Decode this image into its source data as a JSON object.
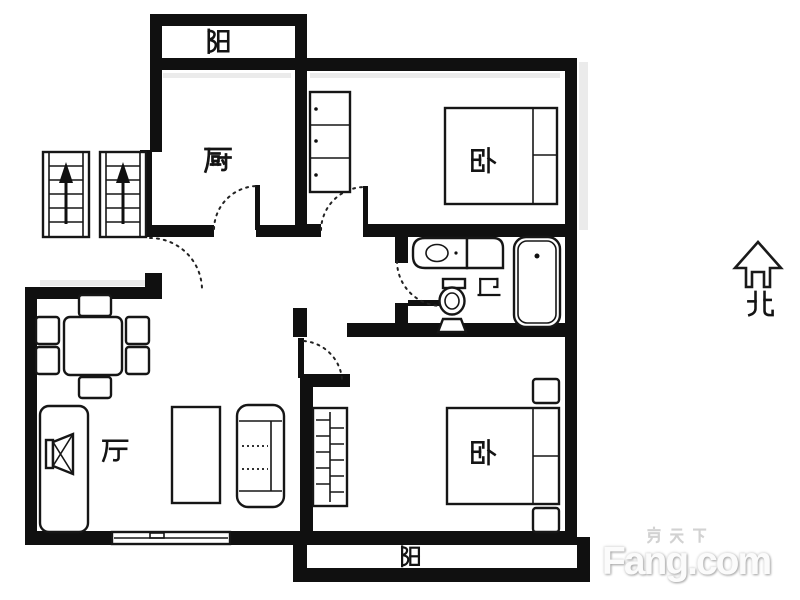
{
  "page": {
    "background": "#ffffff"
  },
  "floorplan": {
    "rooms": [
      {
        "id": "balcony-top",
        "label": "阳",
        "type": "balcony"
      },
      {
        "id": "kitchen",
        "label": "厨",
        "type": "kitchen"
      },
      {
        "id": "bedroom-top",
        "label": "卧",
        "type": "bedroom"
      },
      {
        "id": "bathroom",
        "label": "卫",
        "type": "bathroom"
      },
      {
        "id": "living-room",
        "label": "厅",
        "type": "living-dining"
      },
      {
        "id": "bedroom-bottom",
        "label": "卧",
        "type": "bedroom"
      },
      {
        "id": "balcony-bottom",
        "label": "阳",
        "type": "balcony"
      }
    ],
    "compass": {
      "label": "北",
      "icon": "north-arrow-icon"
    },
    "furniture_icons": [
      "staircase-up-icon",
      "staircase-up-icon",
      "storage-cabinet-icon",
      "double-bed-icon",
      "sink-vanity-icon",
      "washing-machine-icon",
      "toilet-icon",
      "bathtub-icon",
      "dining-table-icon",
      "chair-icon",
      "tv-cabinet-icon",
      "tv-icon",
      "coffee-table-icon",
      "sofa-icon",
      "window-icon",
      "wardrobe-icon",
      "double-bed-icon",
      "nightstand-icon",
      "nightstand-icon",
      "door-swing-icon",
      "door-swing-icon",
      "door-swing-icon",
      "door-swing-icon",
      "door-swing-icon"
    ],
    "colors": {
      "walls": "#101010",
      "background": "#ffffff",
      "furniture_stroke": "#161616",
      "watermark": "#d6d6d6"
    }
  },
  "watermark": {
    "cjk": "房天下",
    "latin": "Fang.com"
  }
}
